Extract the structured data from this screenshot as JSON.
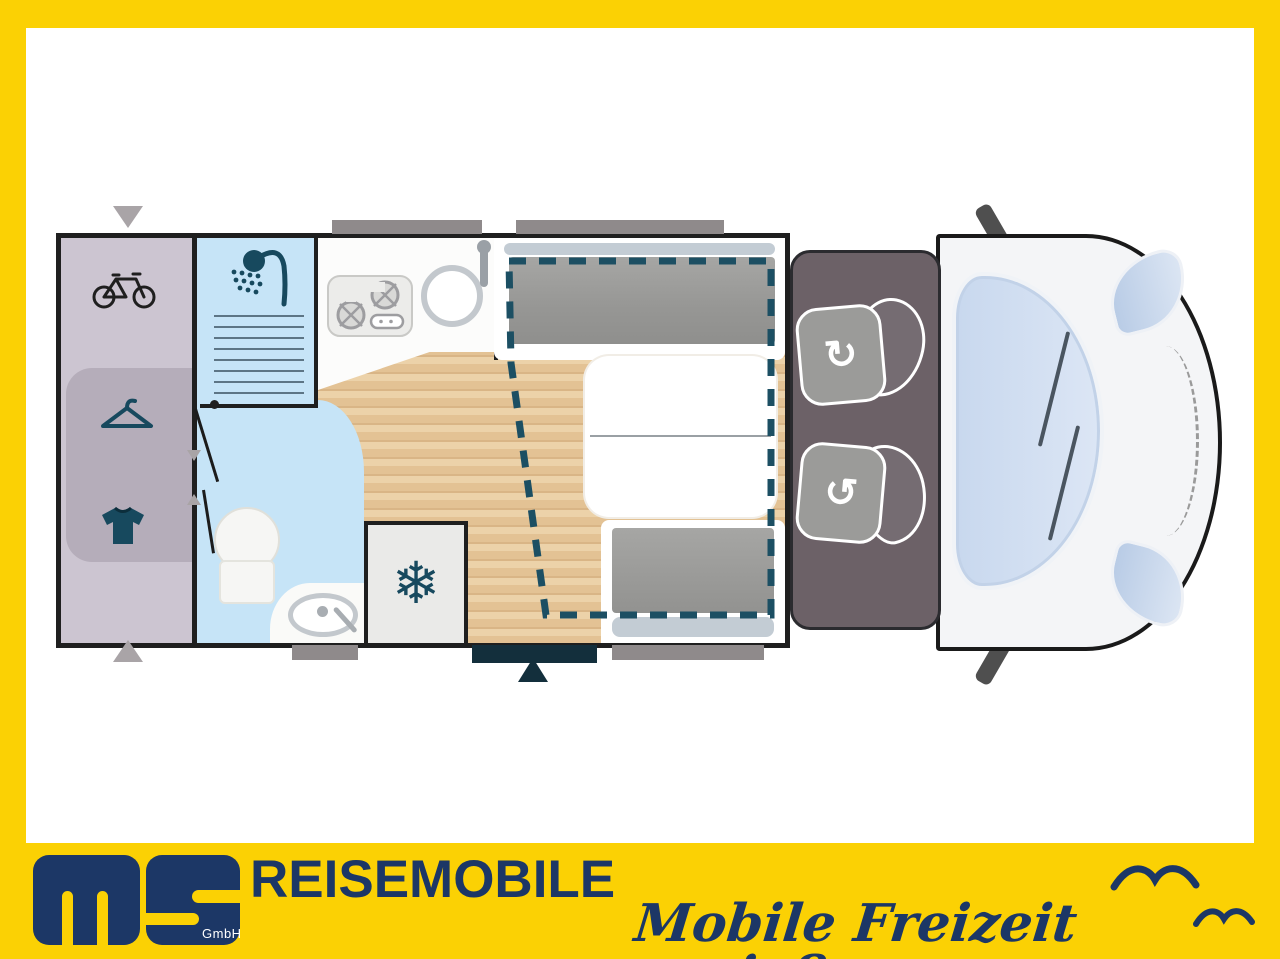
{
  "brand": {
    "title": "REISEMOBILE",
    "gmbh": "GmbH",
    "tagline": "Mobile Freizeit genießen."
  },
  "glyphs": {
    "snowflake": "❄",
    "rotate_cw": "↻",
    "rotate_ccw": "↺"
  },
  "colors": {
    "frame_yellow": "#FBD104",
    "brand_navy": "#1C3766",
    "icon_teal": "#17495E",
    "bed_outline": "#1C4F63",
    "garage_lavender": "#CCC5D1",
    "bath_blue": "#C6E4F7",
    "wood_floor": "#E5C69C",
    "cab_gray": "#6C6167",
    "window_gray": "#8F8A8B",
    "entrance_dark": "#132F3C",
    "van_body": "#F4F5F7",
    "windshield_blue": "#D8E4F4"
  },
  "floorplan": {
    "zones": [
      "rear-garage",
      "shower",
      "washroom",
      "kitchen",
      "lounge-dinette",
      "drop-down-bed-outline",
      "fridge",
      "swivel-cab-seats",
      "entrance-door"
    ],
    "icons": [
      "bicycle",
      "clothes-hanger",
      "t-shirt",
      "shower-head",
      "gas-hob",
      "round-sink",
      "washbasin",
      "toilet",
      "snowflake-fridge",
      "seat-rotation-arrows"
    ]
  }
}
